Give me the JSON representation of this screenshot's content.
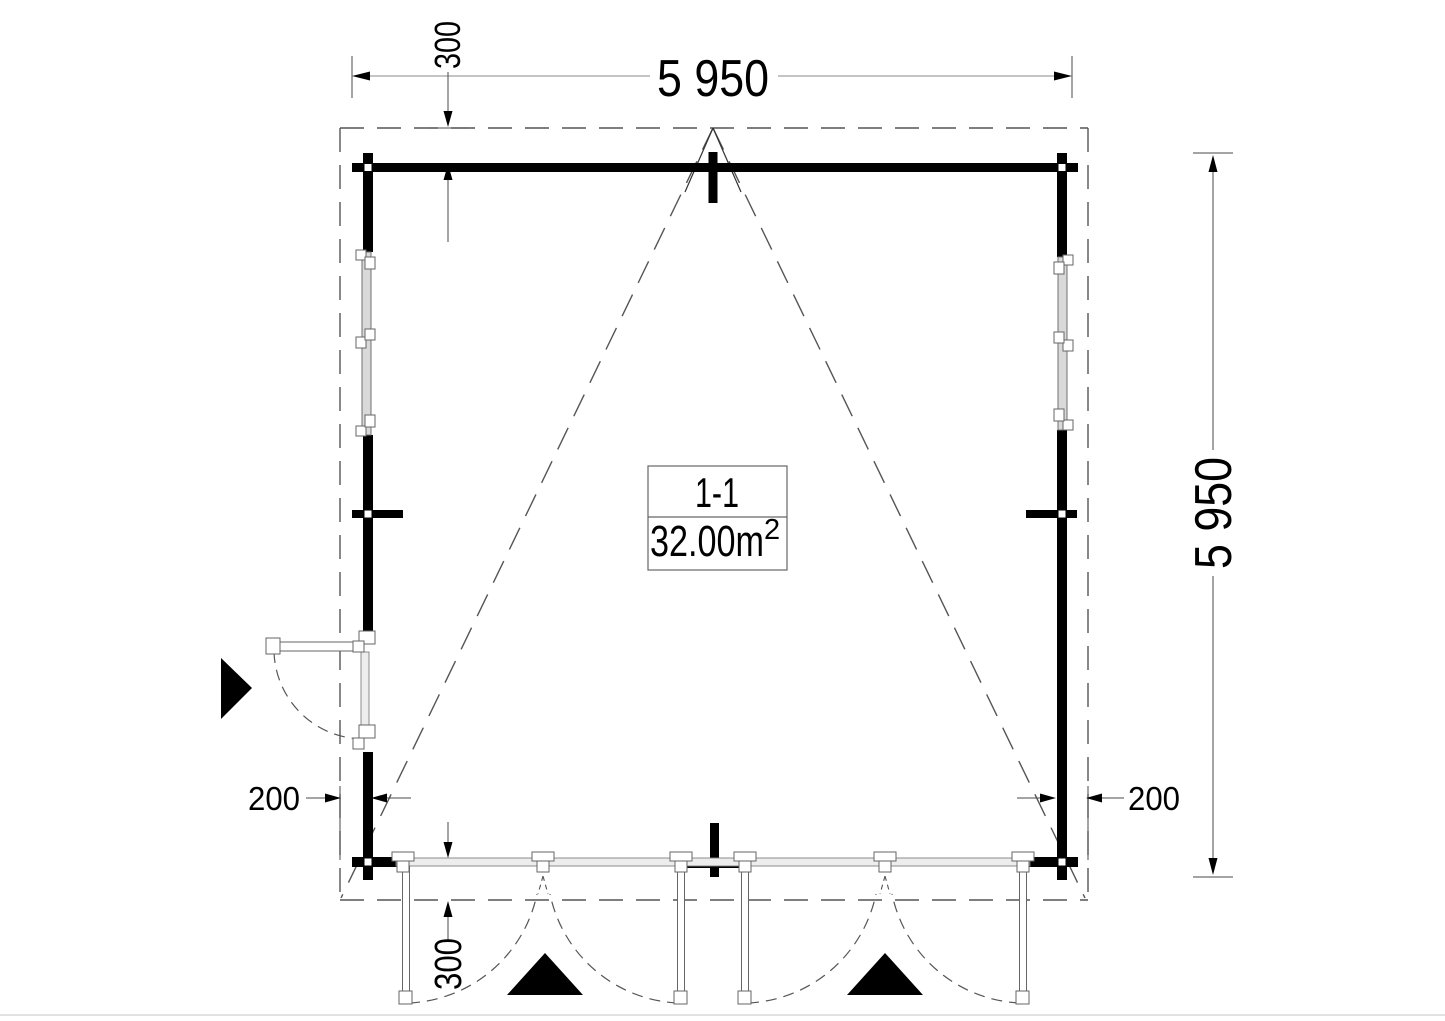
{
  "dimensions": {
    "overall_width_mm": "5 950",
    "overall_depth_mm": "5 950",
    "roof_overhang_top_mm": "300",
    "roof_overhang_bottom_mm": "300",
    "roof_overhang_left_mm": "200",
    "roof_overhang_right_mm": "200"
  },
  "label_box": {
    "section": "1-1",
    "area_value": "32.00m",
    "area_exponent": "2"
  },
  "colors": {
    "wall": "#000000",
    "dash_line": "#555555",
    "dimension_line": "#4a4a4a",
    "frame_stroke": "#707070",
    "glass_fill": "#d9d9d9",
    "text": "#000000",
    "page_edge": "#d9d9d9"
  }
}
